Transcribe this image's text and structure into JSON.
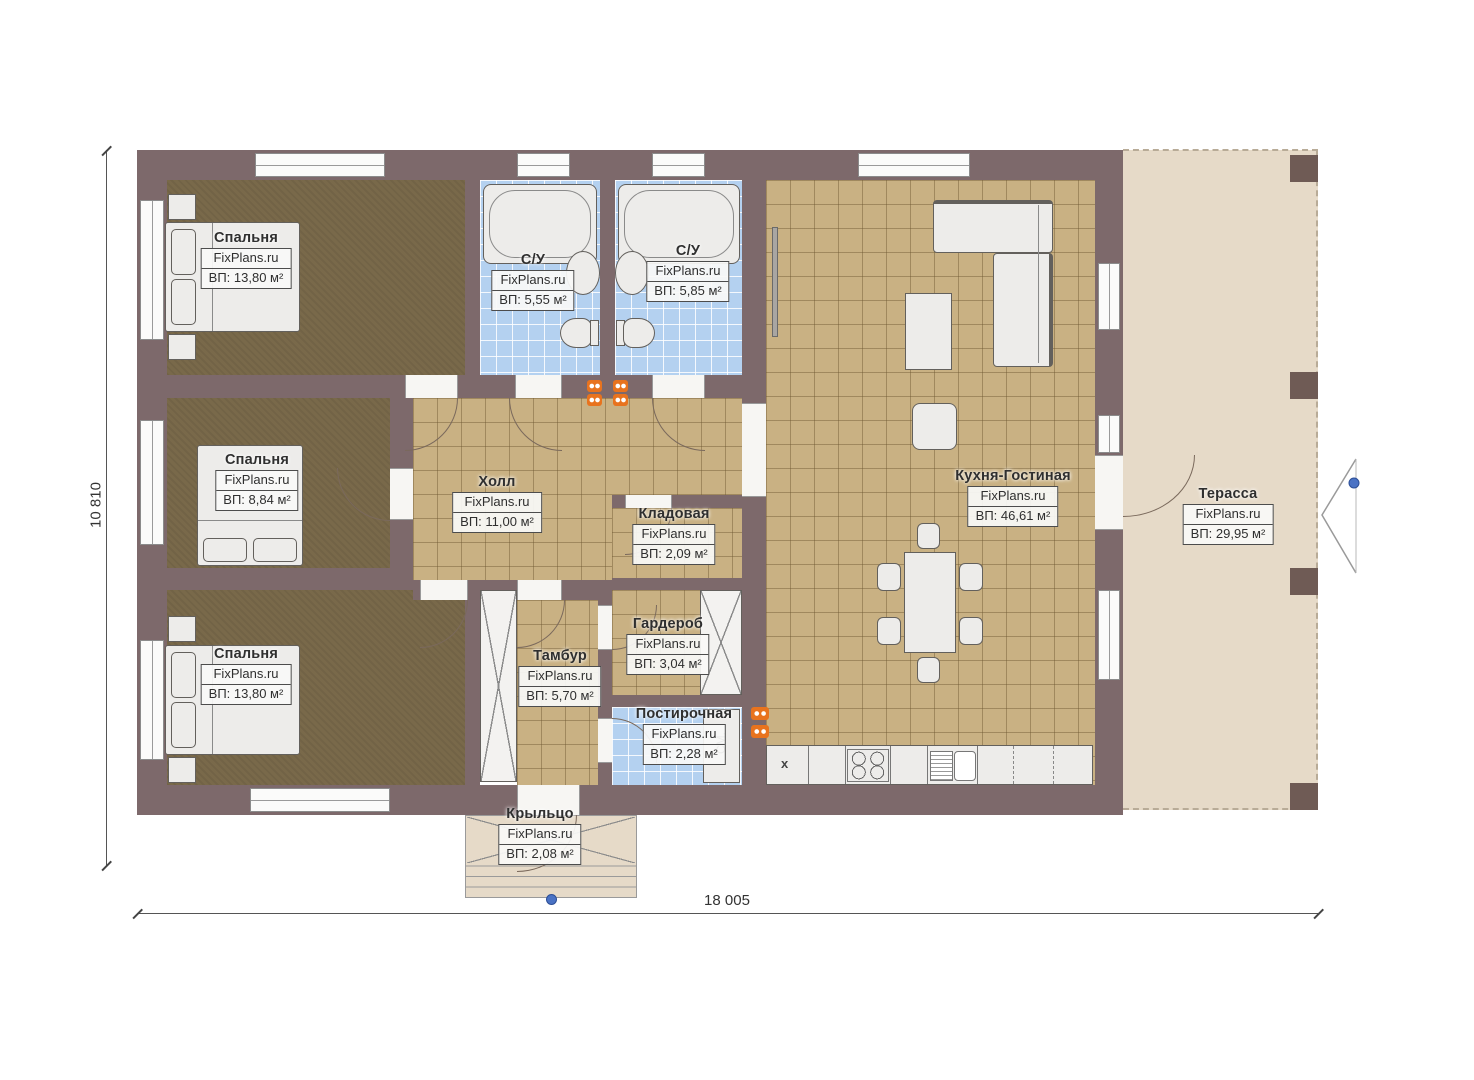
{
  "watermark": "FixPlans.ru",
  "dimensions": {
    "width_mm": "18 005",
    "height_mm": "10 810"
  },
  "rooms": {
    "bedroom1": {
      "name": "Спальня",
      "area": "ВП: 13,80 м²"
    },
    "bath1": {
      "name": "С/У",
      "area": "ВП: 5,55 м²"
    },
    "bath2": {
      "name": "С/У",
      "area": "ВП: 5,85 м²"
    },
    "bedroom2": {
      "name": "Спальня",
      "area": "ВП: 8,84 м²"
    },
    "hall": {
      "name": "Холл",
      "area": "ВП: 11,00 м²"
    },
    "kitchen": {
      "name": "Кухня-Гостиная",
      "area": "ВП: 46,61 м²"
    },
    "storage": {
      "name": "Кладовая",
      "area": "ВП: 2,09 м²"
    },
    "wardrobe": {
      "name": "Гардероб",
      "area": "ВП: 3,04 м²"
    },
    "bedroom3": {
      "name": "Спальня",
      "area": "ВП: 13,80 м²"
    },
    "vestibule": {
      "name": "Тамбур",
      "area": "ВП: 5,70 м²"
    },
    "laundry": {
      "name": "Постирочная",
      "area": "ВП: 2,28 м²"
    },
    "porch": {
      "name": "Крыльцо",
      "area": "ВП: 2,08 м²"
    },
    "terrace": {
      "name": "Терасса",
      "area": "ВП: 29,95 м²"
    }
  },
  "labels": {
    "washer": "СМ.",
    "fridge_mark": "x"
  },
  "colors": {
    "wall": "#7d696b",
    "bedroom_floor": "#79694a",
    "tile_floor": "#c9b183",
    "bath_floor": "#b4d1f0",
    "terrace_floor": "#e6dac8",
    "accent_orange": "#e8731e",
    "marker_blue": "#4a72c4"
  }
}
